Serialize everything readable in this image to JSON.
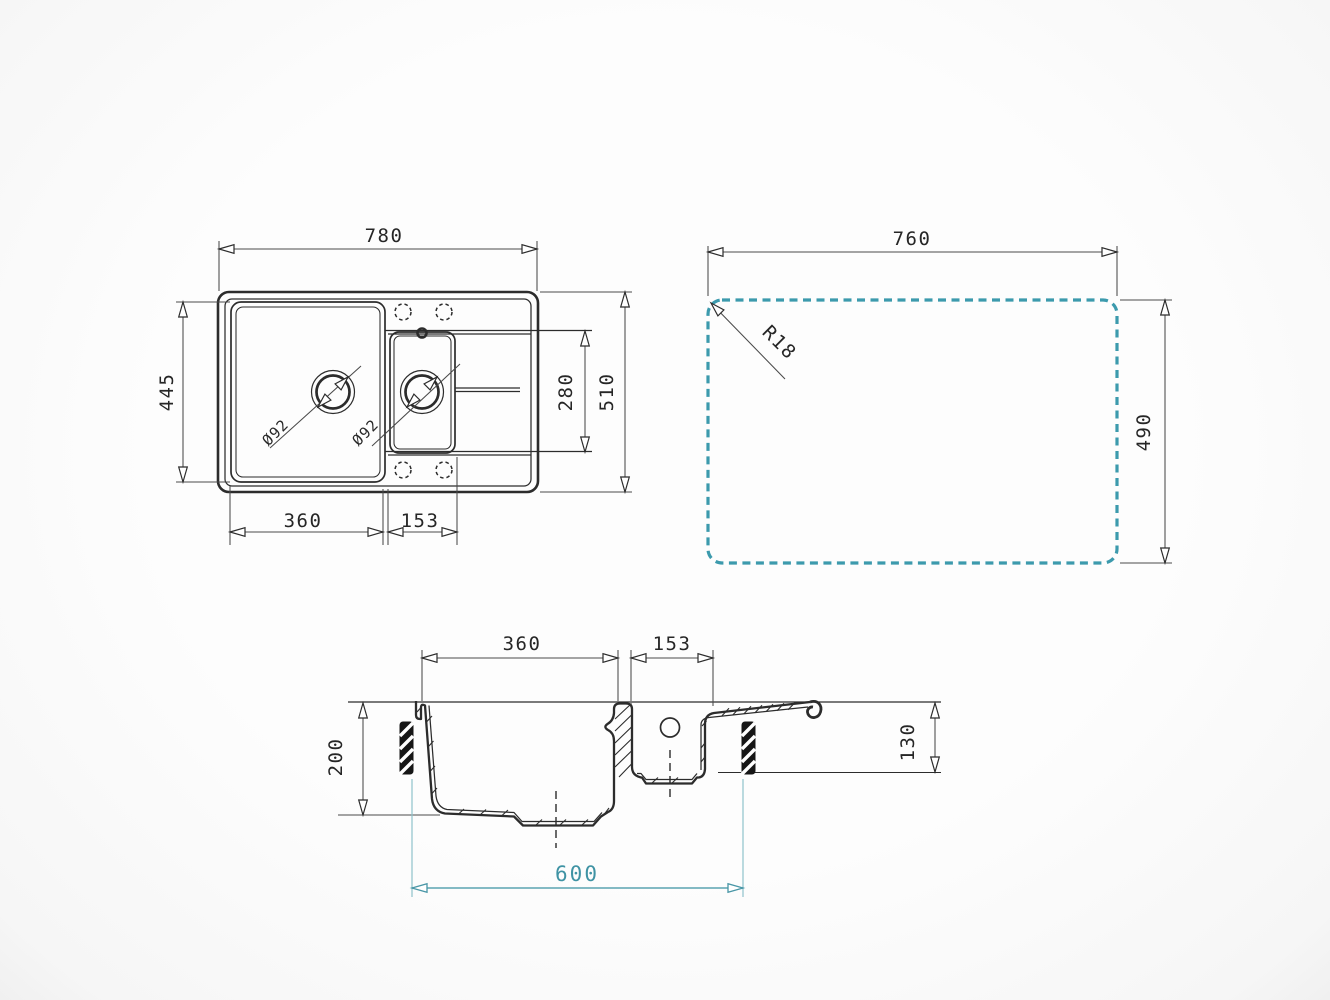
{
  "drawing": {
    "background": "#fbfbfb",
    "line_color": "#2c2c2c",
    "accent_dash_color": "#3c9aad",
    "accent_text_color": "#3f93a4",
    "views": {
      "top": {
        "dims": {
          "overall_width": "780",
          "overall_depth": "510",
          "bowl_depth": "445",
          "main_bowl_width": "360",
          "half_bowl_width": "153",
          "half_bowl_depth": "280",
          "main_drain": "Ø92",
          "half_drain": "Ø92"
        }
      },
      "cutout": {
        "dims": {
          "width": "760",
          "depth": "490",
          "corner_radius": "R18"
        }
      },
      "section": {
        "dims": {
          "main_bowl_width": "360",
          "half_bowl_width": "153",
          "main_bowl_depth": "200",
          "drainer_depth": "130",
          "base_cabinet": "600"
        }
      }
    }
  }
}
